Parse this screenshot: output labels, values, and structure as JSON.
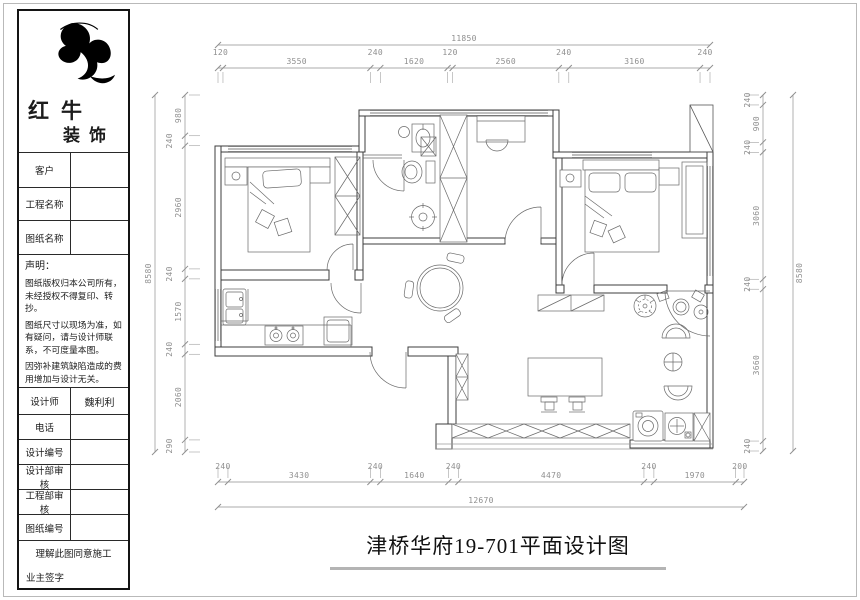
{
  "title_block": {
    "logo": {
      "mark": "bull-logo",
      "brand_top": "红牛",
      "brand_bottom": "装饰"
    },
    "info_rows": [
      {
        "label": "客户",
        "value": ""
      },
      {
        "label": "工程名称",
        "value": ""
      },
      {
        "label": "图纸名称",
        "value": ""
      }
    ],
    "statement": {
      "heading": "声明：",
      "lines": [
        "图纸版权归本公司所有，未经授权不得复印、转抄。",
        "图纸尺寸以现场为准，如有疑问，请与设计师联系，不可度量本图。",
        "因弥补建筑缺陷造成的费用增加与设计无关。"
      ]
    },
    "field_rows": [
      {
        "label": "设计师",
        "value": "魏利利"
      },
      {
        "label": "电话",
        "value": ""
      },
      {
        "label": "设计编号",
        "value": ""
      },
      {
        "label": "设计部审核",
        "value": ""
      },
      {
        "label": "工程部审核",
        "value": ""
      },
      {
        "label": "图纸编号",
        "value": ""
      }
    ],
    "consent_note": "理解此图同意施工",
    "owner_sign_label": "业主签字"
  },
  "drawing": {
    "title": "津桥华府19-701平面设计图",
    "dimensions": {
      "top": {
        "overall": "11850",
        "segments": [
          "120",
          "3550",
          "240",
          "1620",
          "120",
          "2560",
          "240",
          "3160",
          "240"
        ]
      },
      "bottom": {
        "overall": "12670",
        "segments": [
          "240",
          "3430",
          "240",
          "1640",
          "240",
          "4470",
          "240",
          "1970",
          "200"
        ]
      },
      "left": {
        "overall": "8580",
        "segments": [
          "980",
          "240",
          "2960",
          "240",
          "1570",
          "240",
          "2060",
          "290"
        ]
      },
      "right": {
        "overall": "8580",
        "segments": [
          "240",
          "900",
          "240",
          "3060",
          "240",
          "3660",
          "240"
        ]
      }
    },
    "fixtures_shown": [
      "single-bed",
      "double-bed",
      "wardrobe",
      "desk-and-chair",
      "toilet",
      "washbasin",
      "shower-drain",
      "kitchen-sink",
      "gas-stove",
      "refrigerator",
      "round-dining-table",
      "console-table-with-stools",
      "lounge-chairs",
      "potted-plants",
      "washing-machine",
      "laundry-sink",
      "balcony-window-band",
      "door-swings"
    ],
    "colors": {
      "wall_line": "#3c3c3c",
      "furniture_line": "#6a6a6a",
      "dimension_line": "#8f8f8f"
    }
  }
}
